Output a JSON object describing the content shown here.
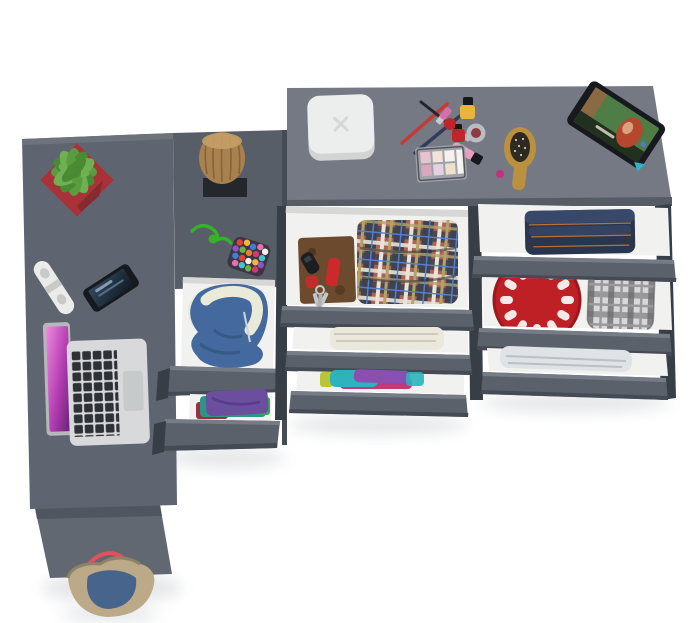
{
  "scene": {
    "title": "Top-down 3D render of a gray corner desk and dresser with open drawers",
    "items": [
      "desk-top",
      "desk-side-panel",
      "tote-bag",
      "succulent-plant-in-red-pot",
      "power-strip",
      "smartphone",
      "open-laptop",
      "wooden-stump-decor",
      "green-cord",
      "pompom-pouch",
      "middle-cabinet-drawers",
      "blue-hoodie",
      "folded-clothes-stack",
      "white-rounded-box",
      "makeup-set",
      "eyeshadow-palette",
      "lip-gloss",
      "nail-polish-bottles",
      "pencils-and-brush",
      "wooden-hairbrush",
      "tablet-with-photo",
      "tartan-shirt",
      "leather-folio-with-keys",
      "pocket-knife",
      "cream-towel",
      "colorful-clothes-roll",
      "folded-jeans",
      "red-plate",
      "gray-plaid-shirt",
      "light-towel"
    ]
  },
  "colors": {
    "bg": "#ffffff",
    "desk": "#5f6570",
    "deskEdge": "#6d737d",
    "deskPanel": "#626871",
    "deskPanelDark": "#50565f",
    "cabinetTop": "#585e68",
    "cabinetSeam": "#464c55",
    "dresserTop": "#747984",
    "dresserEdge": "#565c66",
    "front": "#5b616b",
    "frontLight": "#767c86",
    "frontDark": "#454b54",
    "rail": "#383e46",
    "interior": "#f1f1f0",
    "interiorShadow": "#d7d7d5",
    "potRed": "#a83238",
    "potRedDark": "#872a30",
    "leaf1": "#5b9c41",
    "leaf2": "#4a8a33",
    "leaf3": "#6fb053",
    "leafDark": "#2f5c24",
    "stripWhite": "#ebebea",
    "stripSocket": "#c9c9c7",
    "phoneBody": "#16191e",
    "phoneScreen1": "#33495f",
    "phoneScreen2": "#101a24",
    "laptopBody": "#d7d9da",
    "laptopEdge": "#b6b9bb",
    "laptopKey": "#2e3136",
    "laptopPad": "#c7cacb",
    "pink1": "#f08ade",
    "pink2": "#b23bb0",
    "pink3": "#5f2470",
    "wood": "#a8814f",
    "woodDark": "#7c5c35",
    "woodLight": "#c59e66",
    "pad": "#24272c",
    "cord": "#36b229",
    "pouch": "#3c3545",
    "pom1": "#e04438",
    "pom2": "#f2b63c",
    "pom3": "#3f7fd6",
    "pom4": "#e86fb1",
    "pom5": "#f5f2ea",
    "pom6": "#8e52c9",
    "pom7": "#67b53a",
    "pom8": "#f07f2e",
    "pom9": "#d43a6e",
    "pom10": "#43c2c7",
    "hoodie": "#44699f",
    "hoodieDark": "#34557f",
    "lining": "#e9ead8",
    "purple": "#6b4e9e",
    "tealCloth": "#2f9488",
    "darkRed": "#993041",
    "greenCloth": "#3aa06a",
    "towelCream": "#eae7db",
    "towelCreamLine": "#cfcabb",
    "towelLight": "#dfe3e6",
    "towelLightLine": "#b9c0c6",
    "rollTeal": "#2db3bd",
    "rollPurple": "#8a4fb0",
    "rollMagenta": "#c23a78",
    "rollYellow": "#b9c437",
    "jeans": "#2a364e",
    "jeansLight": "#38486a",
    "stitch": "#c47a3a",
    "plateRed": "#bf2026",
    "plateRedDark": "#9a181e",
    "plaidBase": "#d8d8d8",
    "plaidDark": "#6e6e70",
    "plaidMid": "#9a9a9c",
    "tartanRed": "#b06055",
    "tartanNavy": "#3d4450",
    "tartanCream": "#e8e4d8",
    "tartanOlive": "#b0a468",
    "tartanBlue": "#5a7fd0",
    "folio": "#6b4a2e",
    "folioDark": "#50351f",
    "knifeRed": "#cc2a2a",
    "keySilver": "#c3c6ca",
    "fobBlack": "#1c1e22",
    "boxWhite": "#eceded",
    "boxSide": "#d2d3d2",
    "boxMark": "#d6d7d6",
    "brushWood": "#bb9140",
    "brushPad": "#2e2a22",
    "tabletBody": "#17191e",
    "tabletGreen": "#4e7d46",
    "tabletWood": "#8a6a42",
    "hairRed": "#b5472e",
    "skin": "#d9a27e",
    "accentBlue": "#4a79e8",
    "caseTeal": "#2ab6c7",
    "bagCanvas": "#bba988",
    "bagCanvasDark": "#8f8268",
    "bagDenim": "#47648c",
    "bagStrap": "#e5505e",
    "pencilRed": "#c43b35",
    "pencilNavy": "#2f3d5a",
    "brushBlack": "#23252a",
    "ferrule": "#b9bdc2",
    "lipstick": "#d96fa8",
    "lipstickBase": "#c7cacd",
    "polishYellow": "#e8b63c",
    "capBlack": "#17181c",
    "polishRed": "#c3242c",
    "jarSilver": "#b9bdc2",
    "jarRed": "#8f3a42",
    "gloss": "#eb9ec4",
    "magenta": "#c2327e",
    "paletteFrame": "#9fa3a9",
    "paletteInner": "#53565c",
    "pan1": "#e8c3cf",
    "pan2": "#f2e2da",
    "pan3": "#f6f1ec",
    "pan4": "#d9a8bc",
    "pan5": "#e3d3e0",
    "pan6": "#efe0cf",
    "panBig": "#f7f4f0",
    "shadow": "#9aa0a6"
  }
}
